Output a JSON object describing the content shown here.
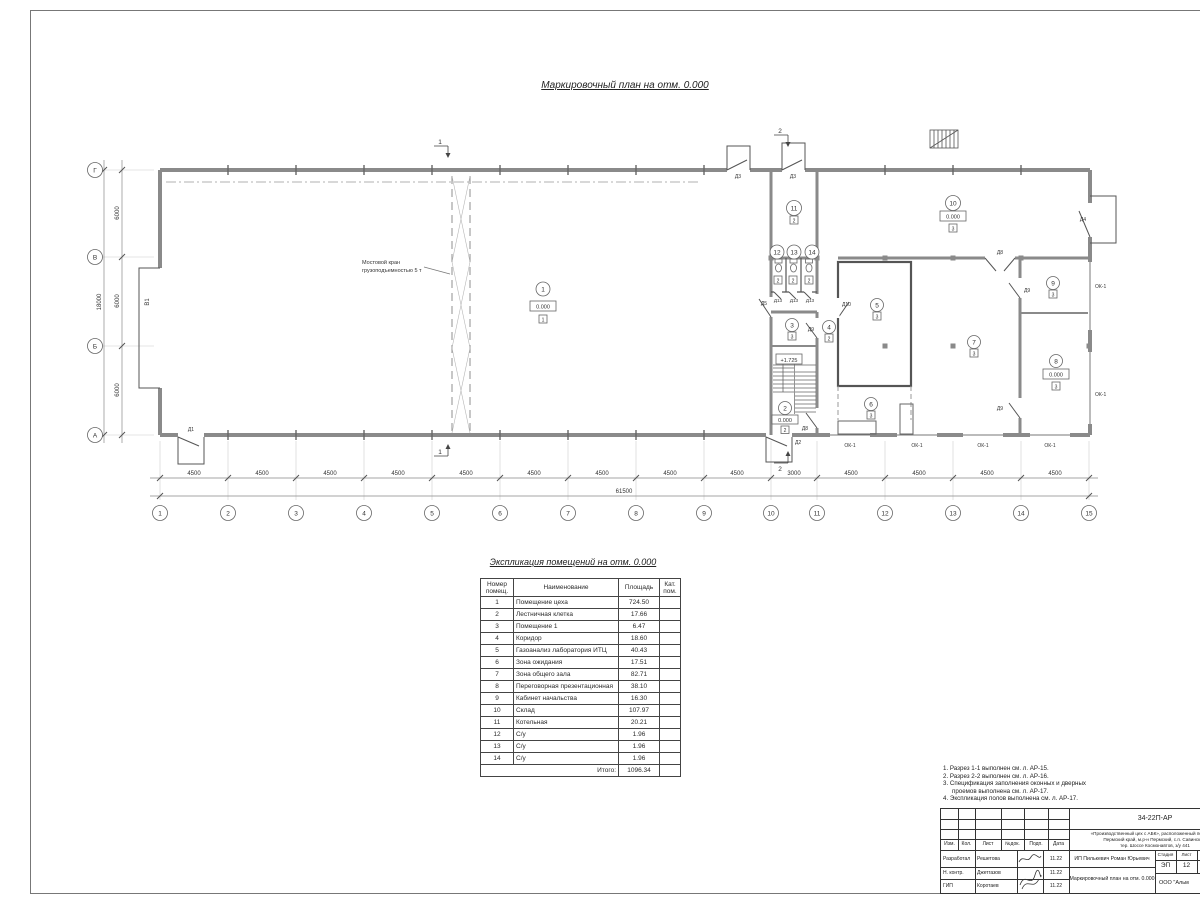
{
  "sheet": {
    "plan_title": "Маркировочный план  на отм. 0.000",
    "table_title": "Экспликация помещений на отм. 0.000"
  },
  "plan": {
    "crane_line1": "Мостовой кран",
    "crane_line2": "грузоподъемностью 5 т",
    "gate_label": "В1",
    "stair_elev": "+1.725",
    "window_label": "ОК-1",
    "sec1": "1",
    "sec2": "2",
    "grid_cols": [
      "1",
      "2",
      "3",
      "4",
      "5",
      "6",
      "7",
      "8",
      "9",
      "10",
      "11",
      "12",
      "13",
      "14",
      "15"
    ],
    "grid_rows": [
      "Г",
      "В",
      "Б",
      "А"
    ],
    "dims_bottom": [
      "4500",
      "4500",
      "4500",
      "4500",
      "4500",
      "4500",
      "4500",
      "4500",
      "4500",
      "3000",
      "4500",
      "4500",
      "4500",
      "4500"
    ],
    "total_bottom": "61500",
    "dims_left": [
      "6000",
      "6000",
      "6000"
    ],
    "total_left": "18000",
    "rooms": {
      "r1": {
        "n": "1",
        "e": "0.000",
        "c": "1"
      },
      "r2": {
        "n": "2",
        "e": "0.000",
        "c": "2"
      },
      "r3": {
        "n": "3",
        "c": "3"
      },
      "r4": {
        "n": "4",
        "c": "2"
      },
      "r5": {
        "n": "5",
        "c": "3"
      },
      "r6": {
        "n": "6",
        "c": "3"
      },
      "r7": {
        "n": "7",
        "c": "3"
      },
      "r8": {
        "n": "8",
        "e": "0.000",
        "c": "3"
      },
      "r9": {
        "n": "9",
        "c": "3"
      },
      "r10": {
        "n": "10",
        "e": "0.000",
        "c": "3"
      },
      "r11": {
        "n": "11",
        "c": "2"
      },
      "r12": {
        "n": "12",
        "c": "2"
      },
      "r13": {
        "n": "13",
        "c": "2"
      },
      "r14": {
        "n": "14",
        "c": "2"
      }
    },
    "doors": {
      "d1": "Д1",
      "d2": "Д2",
      "d3": "Д3",
      "d4": "Д4",
      "d5": "Д5",
      "d8": "Д8",
      "d9": "Д9",
      "d10": "Д10",
      "d13": "Д13"
    }
  },
  "table": {
    "headers": {
      "num": "Номер помещ.",
      "name": "Наименование",
      "area": "Площадь",
      "cat": "Кат. пом."
    },
    "rows": [
      {
        "num": "1",
        "name": "Помещение цеха",
        "area": "724.50"
      },
      {
        "num": "2",
        "name": "Лестничная клетка",
        "area": "17.66"
      },
      {
        "num": "3",
        "name": "Помещение 1",
        "area": "6.47"
      },
      {
        "num": "4",
        "name": "Коридор",
        "area": "18.60"
      },
      {
        "num": "5",
        "name": "Газоанализ лаборатория ИТЦ",
        "area": "40.43"
      },
      {
        "num": "6",
        "name": "Зона ожидания",
        "area": "17.51"
      },
      {
        "num": "7",
        "name": "Зона общего зала",
        "area": "82.71"
      },
      {
        "num": "8",
        "name": "Переговорная презентационная",
        "area": "38.10"
      },
      {
        "num": "9",
        "name": "Кабинет начальства",
        "area": "16.30"
      },
      {
        "num": "10",
        "name": "Склад",
        "area": "107.97"
      },
      {
        "num": "11",
        "name": "Котельная",
        "area": "20.21"
      },
      {
        "num": "12",
        "name": "С/у",
        "area": "1.96"
      },
      {
        "num": "13",
        "name": "С/у",
        "area": "1.96"
      },
      {
        "num": "14",
        "name": "С/у",
        "area": "1.96"
      }
    ],
    "total_label": "Итого:",
    "total_value": "1096.34"
  },
  "notes": {
    "line1": "1. Разрез 1-1 выполнен см. л. АР-15.",
    "line2": "2. Разрез 2-2 выполнен см. л. АР-16.",
    "line3a": "3. Спецификация заполнения оконных и дверных",
    "line3b": "проемов выполнена см. л. АР-17.",
    "line4": "4. Экспликация полов выполнена см. л. АР-17."
  },
  "stamp": {
    "doc_number": "34-22П-АР",
    "object_line1": "«Производственный цех с АБК», расположенный по адресу:",
    "object_line2": "Пермский край, м.р-н Пермский, с.п. Савинское,",
    "object_line3": "тер. Шоссе Космонавтов, з/у 441",
    "cols": {
      "izm": "Изм.",
      "kol": "Кол.",
      "list": "Лист",
      "ndok": "№док.",
      "podp": "Подп.",
      "data": "Дата"
    },
    "rows": [
      {
        "role": "Разработал",
        "name": "Решетова",
        "date": "11.22"
      },
      {
        "role": "Н. контр.",
        "name": "Джетгазов",
        "date": "11.22"
      },
      {
        "role": "ГИП",
        "name": "Коротаев",
        "date": "11.22"
      }
    ],
    "client": "ИП Пилькевич Роман Юрьевич",
    "stage_label": "Стадия",
    "sheet_label": "Лист",
    "stage": "ЭП",
    "sheet": "12",
    "subtitle": "Маркировочный план на отм. 0.000",
    "org": "ООО \"Альм"
  }
}
